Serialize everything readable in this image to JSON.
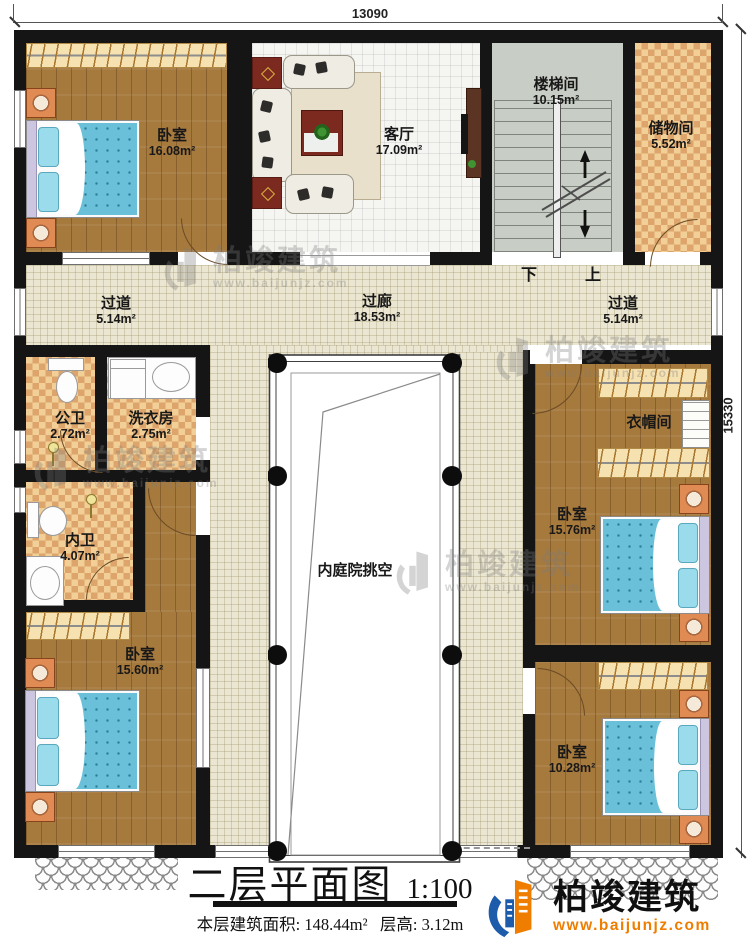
{
  "dimensions": {
    "width_mm": "13090",
    "height_mm": "15330"
  },
  "rooms": [
    {
      "id": "bedroom-top-left",
      "name": "卧室",
      "area": "16.08m²"
    },
    {
      "id": "living-room",
      "name": "客厅",
      "area": "17.09m²"
    },
    {
      "id": "stairwell",
      "name": "楼梯间",
      "area": "10.15m²"
    },
    {
      "id": "storage-room",
      "name": "储物间",
      "area": "5.52m²"
    },
    {
      "id": "corridor-left",
      "name": "过道",
      "area": "5.14m²"
    },
    {
      "id": "gallery-corridor",
      "name": "过廊",
      "area": "18.53m²"
    },
    {
      "id": "corridor-right",
      "name": "过道",
      "area": "5.14m²"
    },
    {
      "id": "public-bathroom",
      "name": "公卫",
      "area": "2.72m²"
    },
    {
      "id": "laundry-room",
      "name": "洗衣房",
      "area": "2.75m²"
    },
    {
      "id": "private-bathroom",
      "name": "内卫",
      "area": "4.07m²"
    },
    {
      "id": "cloakroom",
      "name": "衣帽间",
      "area": ""
    },
    {
      "id": "bedroom-right-middle",
      "name": "卧室",
      "area": "15.76m²"
    },
    {
      "id": "bedroom-bottom-left",
      "name": "卧室",
      "area": "15.60m²"
    },
    {
      "id": "bedroom-bottom-right",
      "name": "卧室",
      "area": "10.28m²"
    },
    {
      "id": "courtyard-void",
      "name": "内庭院挑空",
      "area": ""
    }
  ],
  "stairs": {
    "down_label": "下",
    "up_label": "上"
  },
  "title_block": {
    "title": "二层平面图",
    "scale": "1:100",
    "area_label": "本层建筑面积:",
    "area_value": "148.44m²",
    "height_label": "层高:",
    "height_value": "3.12m"
  },
  "logo": {
    "name": "柏竣建筑",
    "website": "www.baijunjz.com"
  },
  "watermark": {
    "name": "柏竣建筑",
    "website": "www.baijunjz.com"
  },
  "colors": {
    "wall": "#151515",
    "wood_floor": "#a6793d",
    "corridor_tile": "#ebe6d1",
    "checker_light": "#f1cf97",
    "checker_dark": "#dda56c",
    "bed_blue": "#6ac0d8",
    "stair_floor": "#c8cec5",
    "logo_orange": "#ef7d00",
    "logo_blue": "#1d5cab"
  }
}
